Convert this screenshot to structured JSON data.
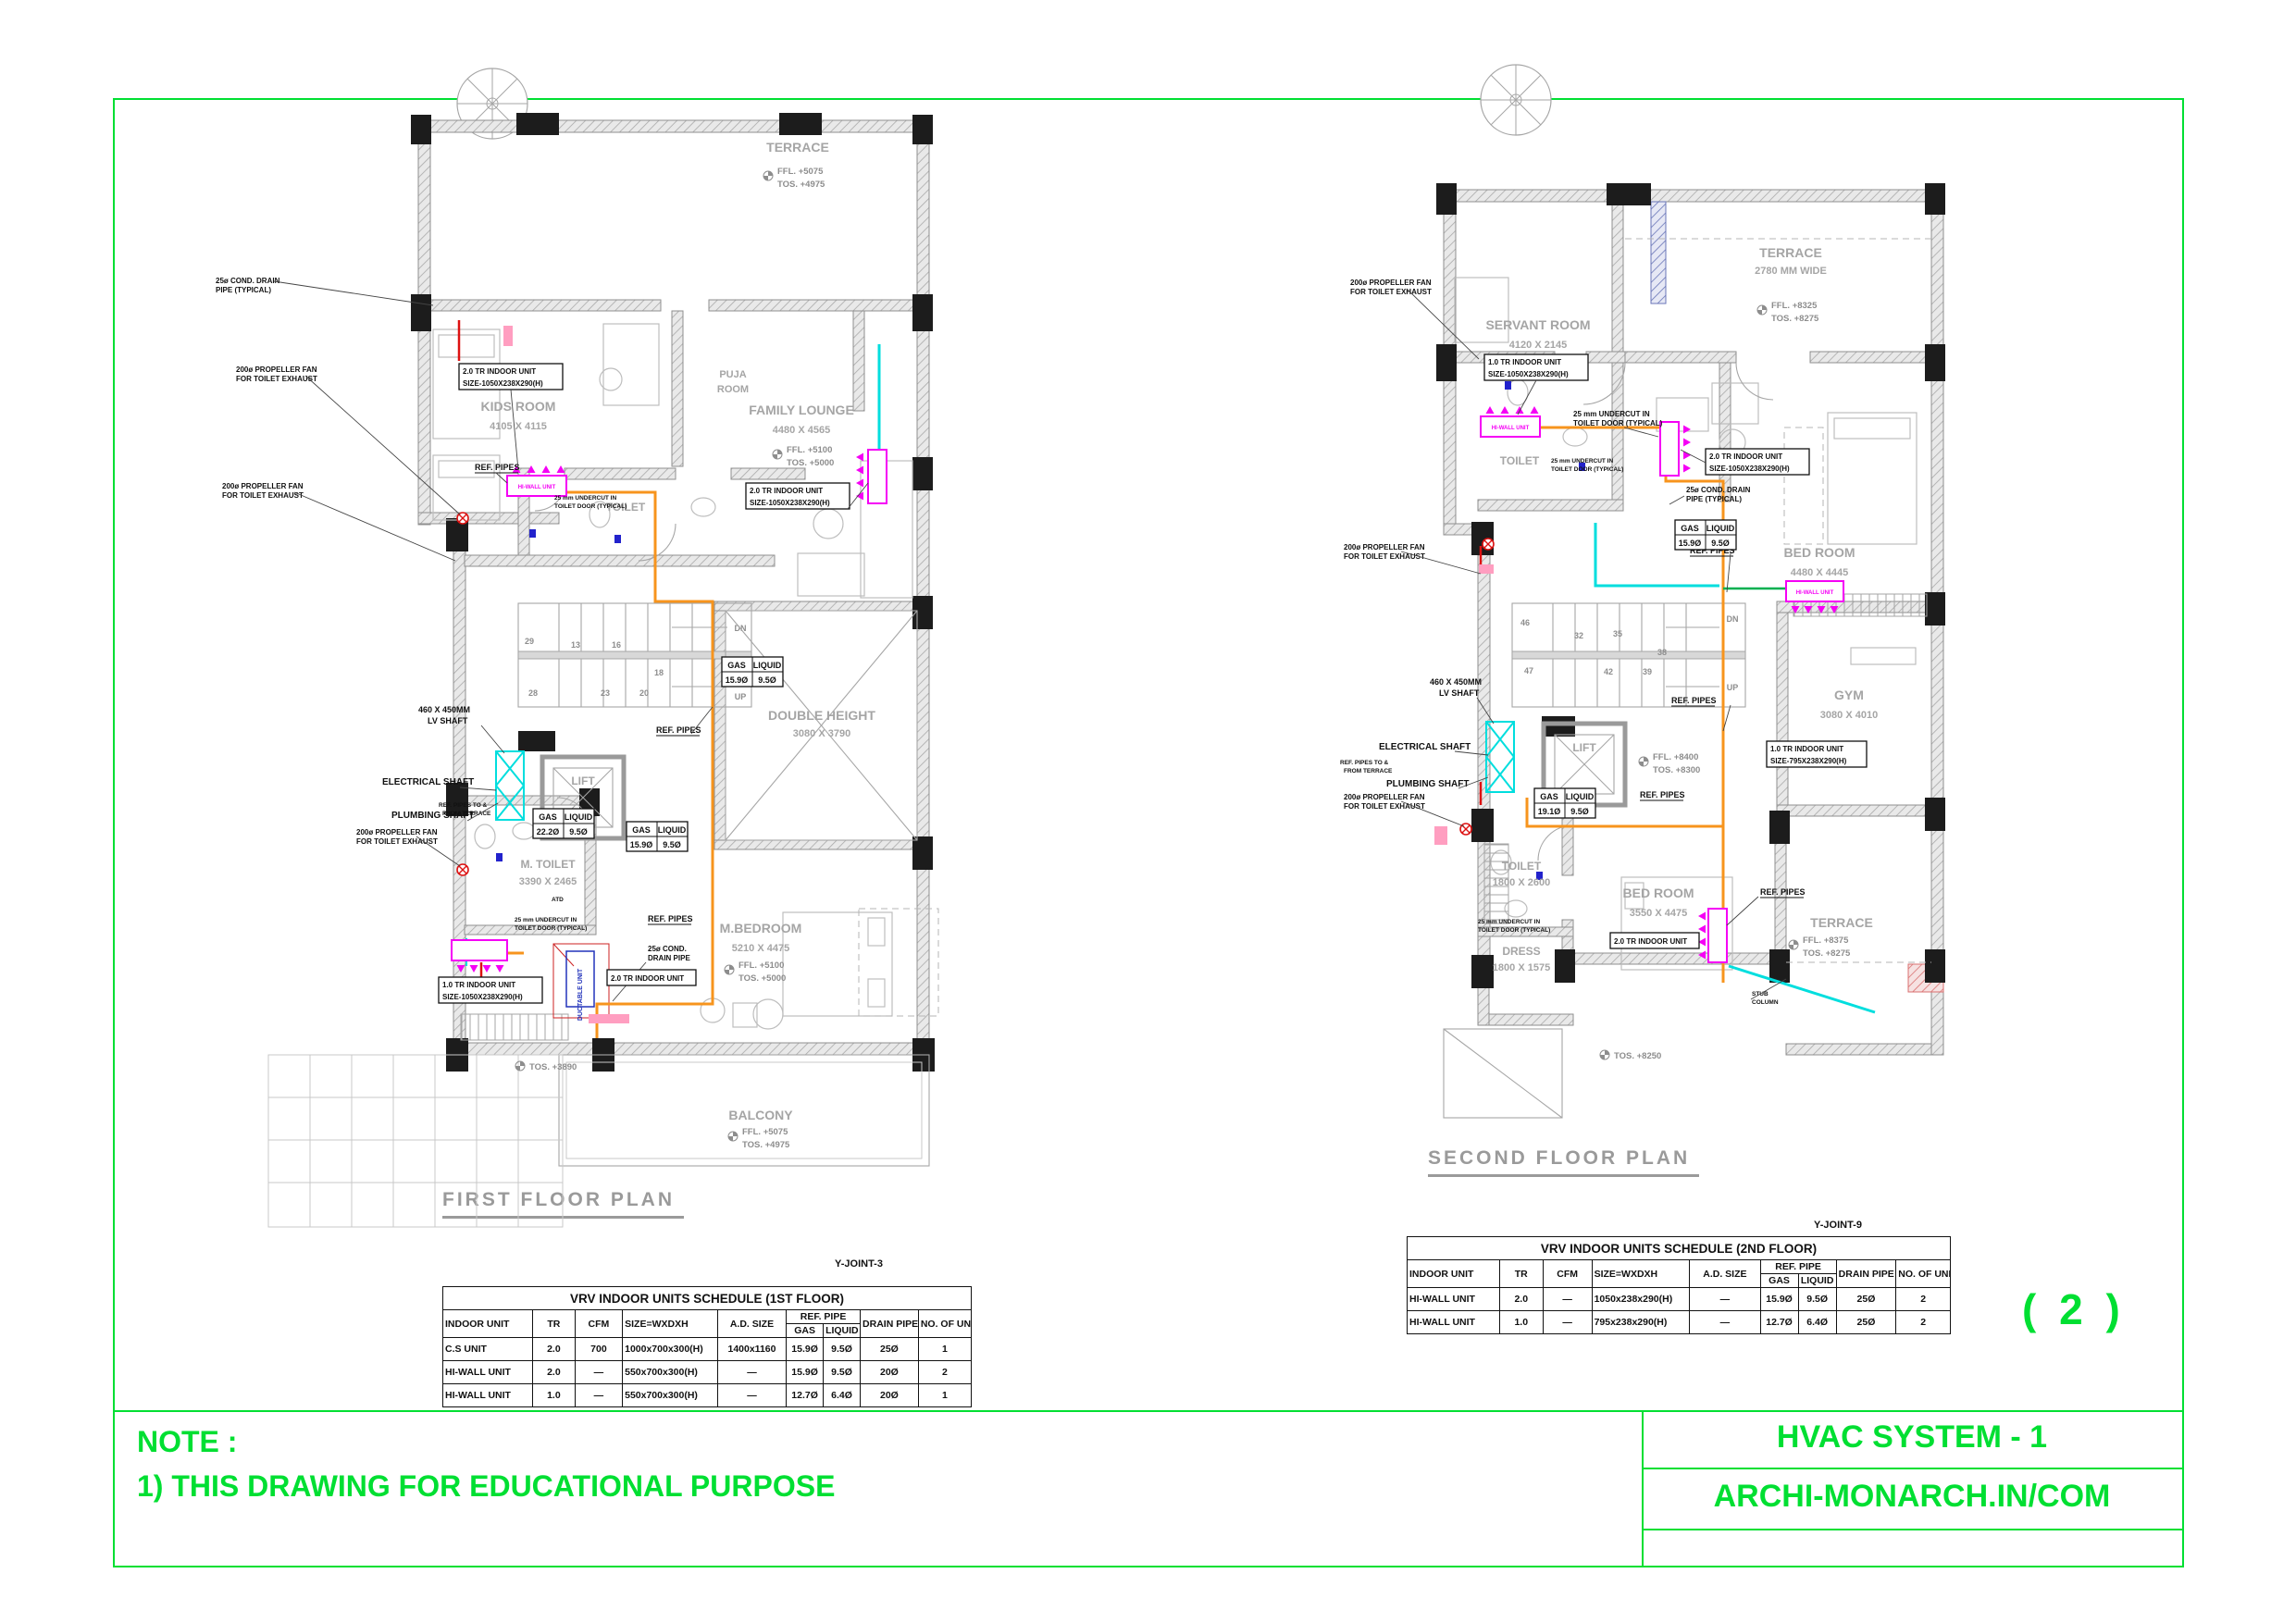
{
  "sheet": {
    "page_number": "( 2 )",
    "note": {
      "title": "NOTE :",
      "line1": "1) THIS DRAWING FOR EDUCATIONAL PURPOSE"
    },
    "title_block": {
      "project": "HVAC SYSTEM - 1",
      "website": "ARCHI-MONARCH.IN/COM"
    },
    "colors": {
      "green": "#00df32",
      "orange": "#f7941d",
      "cyan": "#00dede",
      "magenta": "#f500f5",
      "red": "#dd1111",
      "blue": "#2222cc",
      "wall_gray": "#9a9a9a"
    }
  },
  "ann": {
    "cond_drain_l1": "25ø COND. DRAIN",
    "cond_drain_l2": "PIPE (TYPICAL)",
    "cond_short_l1": "25ø COND.",
    "cond_short_l2": "DRAIN PIPE",
    "fan_l1": "200ø PROPELLER FAN",
    "fan_l2": "FOR TOILET EXHAUST",
    "undercut_l1": "25 mm UNDERCUT IN",
    "undercut_l2": "TOILET DOOR (TYPICAL)",
    "ref_pipes": "REF. PIPES",
    "ref_terrace_l1": "REF. PIPES TO &",
    "ref_terrace_l2": "FROM TERRACE",
    "gas": "GAS",
    "liquid": "LIQUID",
    "lv_l1": "460 X 450MM",
    "lv_l2": "LV SHAFT",
    "electrical": "ELECTRICAL SHAFT",
    "plumbing": "PLUMBING SHAFT",
    "stub_l1": "STUB",
    "stub_l2": "COLUMN",
    "hiwall": "HI-WALL UNIT",
    "ductable": "DUCTABLE UNIT",
    "atd": "ATD",
    "dn": "DN",
    "up": "UP"
  },
  "units": {
    "u20": "2.0 TR INDOOR UNIT",
    "u10": "1.0 TR INDOOR UNIT",
    "size1050": "SIZE-1050X238X290(H)",
    "size795": "SIZE-795X238X290(H)"
  },
  "pipes": {
    "ff1": {
      "gas": "15.9Ø",
      "liquid": "9.5Ø"
    },
    "ff2": {
      "gas": "22.2Ø",
      "liquid": "9.5Ø"
    },
    "ff3": {
      "gas": "15.9Ø",
      "liquid": "9.5Ø"
    },
    "sf1": {
      "gas": "15.9Ø",
      "liquid": "9.5Ø"
    },
    "sf2": {
      "gas": "19.1Ø",
      "liquid": "9.5Ø"
    }
  },
  "plans": {
    "first": {
      "title": "FIRST FLOOR PLAN",
      "yjoint": "Y-JOINT-3",
      "terrace": {
        "name": "TERRACE",
        "ffl": "FFL. +5075",
        "tos": "TOS. +4975"
      },
      "puja": {
        "l1": "PUJA",
        "l2": "ROOM"
      },
      "kids": {
        "name": "KIDS ROOM",
        "dim": "4105 X 4115"
      },
      "lounge": {
        "name": "FAMILY LOUNGE",
        "dim": "4480 X 4565",
        "ffl": "FFL. +5100",
        "tos": "TOS. +5000"
      },
      "toilet": "TOILET",
      "stairs": [
        "29",
        "13",
        "16",
        "18",
        "28",
        "23",
        "20"
      ],
      "double_height": {
        "name": "DOUBLE HEIGHT",
        "dim": "3080 X 3790"
      },
      "lift": "LIFT",
      "mtoilet": {
        "name": "M. TOILET",
        "dim": "3390 X 2465"
      },
      "mbedroom": {
        "name": "M.BEDROOM",
        "dim": "5210 X 4475",
        "ffl": "FFL. +5100",
        "tos": "TOS. +5000"
      },
      "dress": "DRESS",
      "balcony": {
        "name": "BALCONY",
        "ffl": "FFL. +5075",
        "tos": "TOS. +4975"
      },
      "tos_stair": "TOS. +3890"
    },
    "second": {
      "title": "SECOND FLOOR PLAN",
      "yjoint": "Y-JOINT-9",
      "terrace": {
        "name": "TERRACE",
        "dim": "2780 MM WIDE",
        "ffl": "FFL. +8325",
        "tos": "TOS. +8275"
      },
      "servant": {
        "name": "SERVANT ROOM",
        "dim": "4120 X 2145"
      },
      "toilet1": "TOILET",
      "bedroom1": {
        "name": "BED ROOM",
        "dim": "4480 X 4445"
      },
      "stairs": [
        "46",
        "32",
        "35",
        "38",
        "47",
        "42",
        "39"
      ],
      "gym": {
        "name": "GYM",
        "dim": "3080 X 4010"
      },
      "hall": {
        "ffl": "FFL. +8400",
        "tos": "TOS. +8300"
      },
      "lift": "LIFT",
      "bedroom2": {
        "name": "BED ROOM",
        "dim": "3550 X 4475"
      },
      "toilet2": {
        "name": "TOILET",
        "dim": "1800 X 2600"
      },
      "dress": {
        "name": "DRESS",
        "dim": "1800 X 1575"
      },
      "terrace2": {
        "name": "TERRACE",
        "ffl": "FFL. +8375",
        "tos": "TOS. +8275"
      },
      "tos_terrace": "TOS. +8250"
    }
  },
  "schedules": {
    "first": {
      "title": "VRV INDOOR UNITS  SCHEDULE (1ST  FLOOR)",
      "headers": {
        "indoor_unit": "INDOOR  UNIT",
        "tr": "TR",
        "cfm": "CFM",
        "size": "SIZE=WXDXH",
        "ad_size": "A.D. SIZE",
        "ref_pipe": "REF. PIPE",
        "gas": "GAS",
        "liquid": "LIQUID",
        "drain_pipe": "DRAIN PIPE",
        "no_of_unit": "NO. OF UNIT"
      },
      "rows": [
        [
          "C.S UNIT",
          "2.0",
          "700",
          "1000x700x300(H)",
          "1400x1160",
          "15.9Ø",
          "9.5Ø",
          "25Ø",
          "1"
        ],
        [
          "HI-WALL UNIT",
          "2.0",
          "—",
          "550x700x300(H)",
          "—",
          "15.9Ø",
          "9.5Ø",
          "20Ø",
          "2"
        ],
        [
          "HI-WALL UNIT",
          "1.0",
          "—",
          "550x700x300(H)",
          "—",
          "12.7Ø",
          "6.4Ø",
          "20Ø",
          "1"
        ]
      ]
    },
    "second": {
      "title": "VRV INDOOR UNITS  SCHEDULE (2ND  FLOOR)",
      "headers": {
        "indoor_unit": "INDOOR  UNIT",
        "tr": "TR",
        "cfm": "CFM",
        "size": "SIZE=WXDXH",
        "ad_size": "A.D. SIZE",
        "ref_pipe": "REF. PIPE",
        "gas": "GAS",
        "liquid": "LIQUID",
        "drain_pipe": "DRAIN PIPE",
        "no_of_unit": "NO. OF UNIT"
      },
      "rows": [
        [
          "HI-WALL UNIT",
          "2.0",
          "—",
          "1050x238x290(H)",
          "—",
          "15.9Ø",
          "9.5Ø",
          "25Ø",
          "2"
        ],
        [
          "HI-WALL UNIT",
          "1.0",
          "—",
          "795x238x290(H)",
          "—",
          "12.7Ø",
          "6.4Ø",
          "25Ø",
          "2"
        ]
      ]
    }
  }
}
